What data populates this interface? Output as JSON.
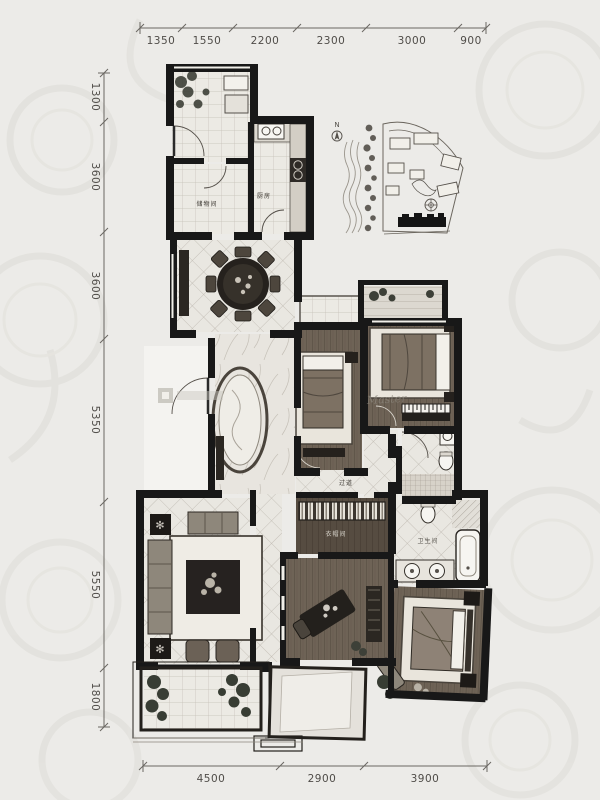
{
  "dimensions": {
    "top": [
      "1350",
      "1550",
      "2200",
      "2300",
      "3000",
      "900"
    ],
    "left": [
      "1300",
      "3600",
      "3600",
      "5350",
      "5550",
      "1800"
    ],
    "bottom": [
      "4500",
      "2900",
      "3900"
    ]
  },
  "rooms": {
    "storage": "储物间",
    "kitchen": "厨房",
    "corridor": "过道",
    "cloakroom": "衣帽间",
    "bathroom": "卫生间"
  },
  "siteplan": {
    "north": "N"
  },
  "watermark": {
    "script": "Master"
  },
  "colors": {
    "wall": "#181818",
    "paper": "#ecebe8",
    "dim_line": "#6a6762"
  }
}
